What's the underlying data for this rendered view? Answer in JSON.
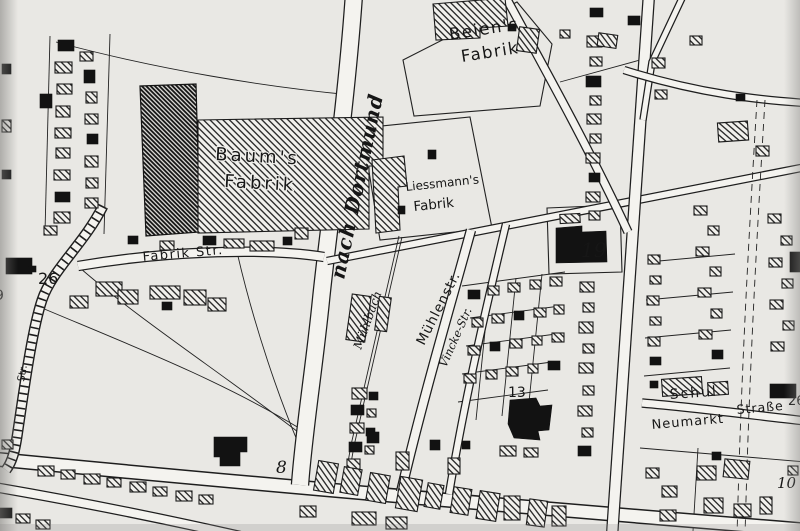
{
  "map": {
    "description": "Scanned historical German town plan (black ink on grey paper)",
    "colors": {
      "paper": "#e9e8e4",
      "ink": "#1c1c1c",
      "road_fill": "#f4f3ef",
      "scan_edge": "#8f8e8b"
    },
    "place_labels": {
      "beiens_line1": "Beien's",
      "beiens_line2": "Fabrik",
      "baums_line1": "Baum's",
      "baums_line2": "Fabrik",
      "liessmanns_line1": "Liessmann's",
      "liessmanns_line2": "Fabrik"
    },
    "street_labels": {
      "nach_dortmund": "nach Dortmund",
      "fabrik_str": "Fabrik Str.",
      "muehlenstr": "Mühlenstr.",
      "muehlbach": "Mühlbach",
      "vincke_str": "Vincke-Str.",
      "schul": "Schul",
      "strasse": "Straße",
      "neumarkt": "Neumarkt",
      "left_edge_fragment": "Str."
    },
    "numbers": {
      "n26": "26",
      "n19": "19",
      "n13": "13",
      "n8": "8",
      "n10": "10",
      "n9": "9",
      "n26_right": "26"
    }
  }
}
